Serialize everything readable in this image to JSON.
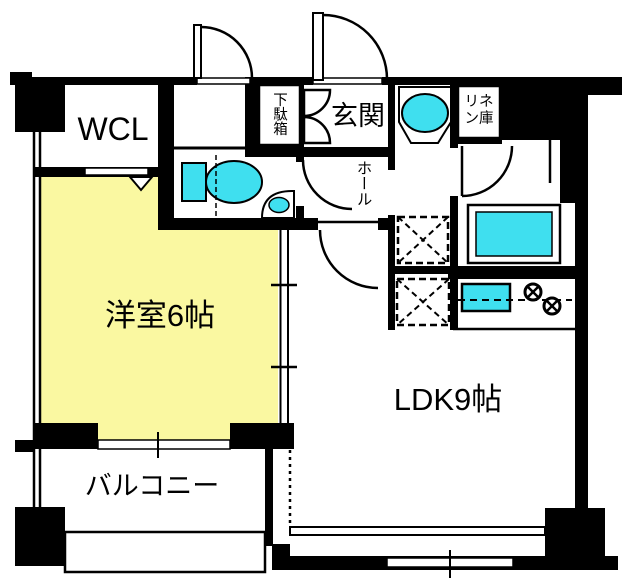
{
  "plan": {
    "rooms": {
      "wcl": "WCL",
      "shoe_cabinet": "下駄箱",
      "entrance": "玄関",
      "hall": "ホール",
      "linen_line1": "リネ",
      "linen_line2": "ン庫",
      "western_room": "洋室6帖",
      "ldk": "LDK9帖",
      "balcony": "バルコニー"
    },
    "fixtures": [
      "toilet-icon",
      "hand-basin-icon",
      "washbasin-icon",
      "bathtub-icon",
      "kitchen-sink-icon",
      "gas-burner-icon",
      "washing-machine-space",
      "refrigerator-space"
    ],
    "colors": {
      "floor": "#FAF8A1",
      "fixture": "#3FDFEF",
      "wall": "#000000",
      "bg": "#FFFFFF"
    }
  }
}
